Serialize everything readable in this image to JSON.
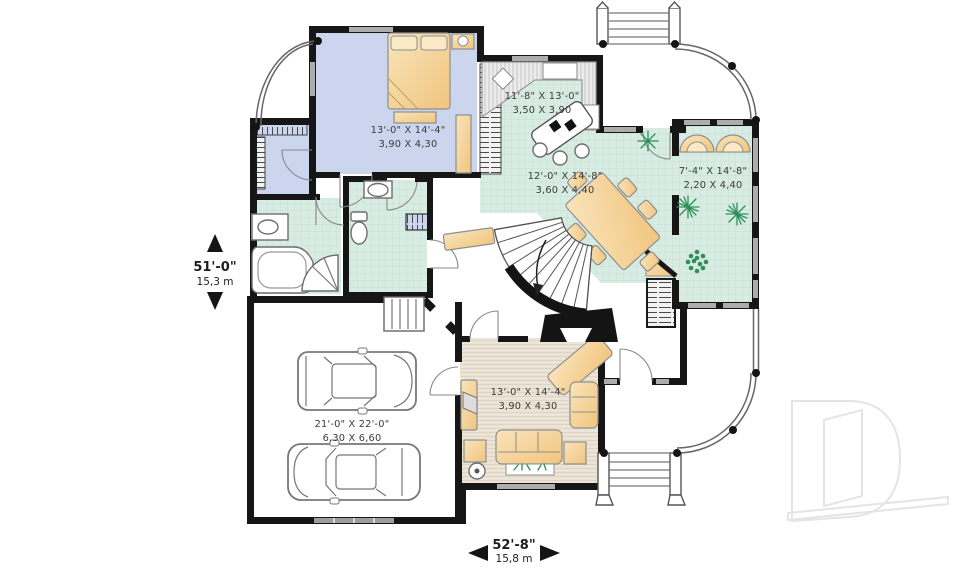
{
  "plan": {
    "rooms": {
      "bedroom": {
        "imperial": "13'-0\" X 14'-4\"",
        "metric": "3,90 X 4,30"
      },
      "kitchen": {
        "imperial": "11'-8\" X 13'-0\"",
        "metric": "3,50 X 3,90"
      },
      "dining": {
        "imperial": "12'-0\" X 14'-8\"",
        "metric": "3,60 X 4,40"
      },
      "sunroom": {
        "imperial": "7'-4\" X 14'-8\"",
        "metric": "2,20 X 4,40"
      },
      "living": {
        "imperial": "13'-0\" X 14'-4\"",
        "metric": "3,90 X 4,30"
      },
      "garage": {
        "imperial": "21'-0\" X 22'-0\"",
        "metric": "6,30 X 6,60"
      }
    },
    "dimensions": {
      "side": {
        "imperial": "51'-0\"",
        "metric": "15,3 m"
      },
      "front": {
        "imperial": "52'-8\"",
        "metric": "15,8 m"
      }
    },
    "watermark_letter": "D",
    "colors": {
      "wall": "#161616",
      "carpet": "#ccd5ee",
      "tile": "#d9ece4",
      "wood": "#ede4d8",
      "furniture": "#f6d9a4"
    }
  }
}
